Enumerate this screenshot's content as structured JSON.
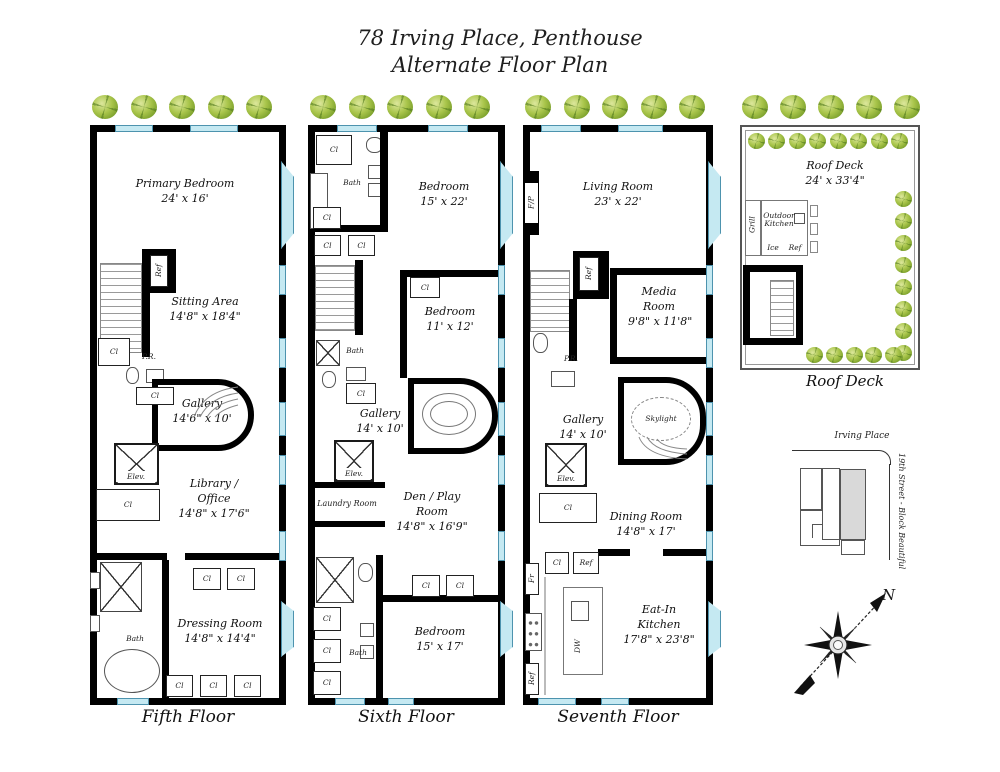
{
  "title": {
    "line1": "78 Irving Place, Penthouse",
    "line2": "Alternate Floor Plan"
  },
  "colors": {
    "wall": "#000000",
    "window": "#c5e9f2",
    "window_border": "#4d93ae",
    "tree": "#8fb83a",
    "map_highlight": "#d9d9d9"
  },
  "floors": {
    "fifth": {
      "caption": "Fifth Floor",
      "rooms": {
        "primary_bedroom": {
          "name": "Primary Bedroom",
          "dims": "24' x 16'"
        },
        "sitting_area": {
          "name": "Sitting Area",
          "dims": "14'8\" x 18'4\""
        },
        "gallery": {
          "name": "Gallery",
          "dims": "14'6\" x 10'"
        },
        "library_office": {
          "name": "Library / Office",
          "dims": "14'8\" x 17'6\""
        },
        "dressing_room": {
          "name": "Dressing Room",
          "dims": "14'8\" x 14'4\""
        }
      },
      "labels": {
        "ref": "Ref",
        "cl": "Cl",
        "pr": "P.R.",
        "elev": "Elev.",
        "bath": "Bath"
      }
    },
    "sixth": {
      "caption": "Sixth Floor",
      "rooms": {
        "bedroom_top": {
          "name": "Bedroom",
          "dims": "15' x 22'"
        },
        "bedroom_middle": {
          "name": "Bedroom",
          "dims": "11' x 12'"
        },
        "gallery": {
          "name": "Gallery",
          "dims": "14' x 10'"
        },
        "laundry": {
          "name": "Laundry Room"
        },
        "den": {
          "name": "Den / Play Room",
          "dims": "14'8\" x 16'9\""
        },
        "bedroom_bottom": {
          "name": "Bedroom",
          "dims": "15' x 17'"
        }
      },
      "labels": {
        "cl": "Cl",
        "bath": "Bath",
        "elev": "Elev."
      }
    },
    "seventh": {
      "caption": "Seventh Floor",
      "rooms": {
        "living": {
          "name": "Living Room",
          "dims": "23' x 22'"
        },
        "media": {
          "name": "Media Room",
          "dims": "9'8\" x 11'8\""
        },
        "gallery": {
          "name": "Gallery",
          "dims": "14' x 10'"
        },
        "dining": {
          "name": "Dining Room",
          "dims": "14'8\" x 17'"
        },
        "kitchen": {
          "name": "Eat-In Kitchen",
          "dims": "17'8\" x 23'8\""
        }
      },
      "labels": {
        "fp": "F/P",
        "ref": "Ref",
        "pr": "P.R.",
        "skylight": "Skylight",
        "elev": "Elev.",
        "cl": "Cl",
        "fr": "Fr",
        "dw": "DW"
      }
    }
  },
  "roof": {
    "caption": "Roof Deck",
    "room": {
      "name": "Roof Deck",
      "dims": "24' x 33'4\""
    },
    "labels": {
      "grill": "Grill",
      "outdoor_kitchen": "Outdoor Kitchen",
      "ice": "Ice",
      "ref": "Ref"
    }
  },
  "map": {
    "street_top": "Irving Place",
    "street_right": "19th Street - Block Beautiful"
  },
  "compass": {
    "north": "N"
  }
}
